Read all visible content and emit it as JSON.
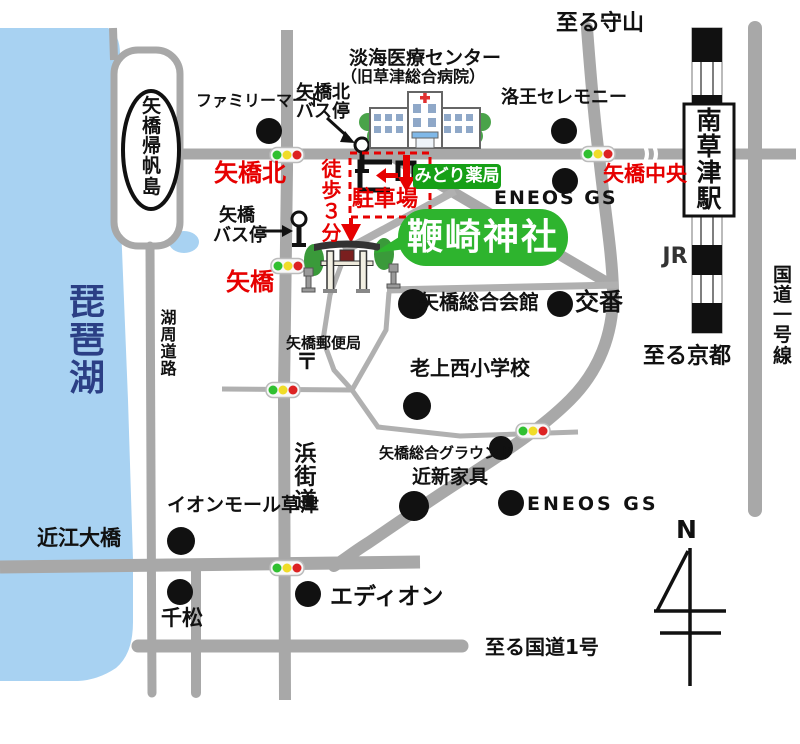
{
  "colors": {
    "road_gray": "#a8a8a8",
    "lake_blue": "#a8d2f2",
    "accent_red": "#e60000",
    "pharmacy_badge_green": "#16a016",
    "shrine_bubble_green": "#2eb42e",
    "lake_text_navy": "#2b3f85",
    "signal_green": "#30c030",
    "signal_yellow": "#f0dc28",
    "signal_red": "#dd2222"
  },
  "icons": {
    "traffic_light": "traffic-light",
    "bus_stop": "bus-stop-pole",
    "torii": "torii-gate",
    "hospital": "hospital-building",
    "compass": "north-arrow",
    "landmark_dot": "black-dot",
    "railway": "jr-railway-band"
  },
  "labels": {
    "to_moriyama": "至る守山",
    "to_kyoto": "至る京都",
    "to_route1": "至る国道1号",
    "route1_vertical": "国道一号線",
    "jr": "JR",
    "station": "南草津駅",
    "lake": "琵琶湖",
    "island": "矢橋帰帆島",
    "lakeside_road": "湖周道路",
    "hama_road": "浜街道",
    "ohashi": "近江大橋",
    "north": "N"
  },
  "intersections": {
    "north": "矢橋北",
    "central": "矢橋中央",
    "yabase": "矢橋"
  },
  "route_guide": {
    "walk": "徒歩３分",
    "parking": "駐車場"
  },
  "bus_stops": {
    "north_line1": "矢橋北",
    "north_line2": "バス停",
    "yabase_line1": "矢橋",
    "yabase_line2": "バス停"
  },
  "destination": {
    "shrine": "鞭崎神社",
    "pharmacy": "みどり薬局"
  },
  "hospital": {
    "name": "淡海医療センター",
    "former": "（旧草津総合病院）"
  },
  "landmarks": {
    "familymart": "ファミリーマート",
    "rakuo": "洛王セレモニー",
    "eneos_north": "ENEOS GS",
    "kaikan": "矢橋総合会館",
    "koban": "交番",
    "school": "老上西小学校",
    "ground": "矢橋総合グラウンド",
    "kagu": "近新家具",
    "eneos_south": "ENEOS GS",
    "aeon": "イオンモール草津",
    "post_office": "矢橋郵便局",
    "post_mark": "〒",
    "senmatsu": "千松",
    "edion": "エディオン"
  }
}
